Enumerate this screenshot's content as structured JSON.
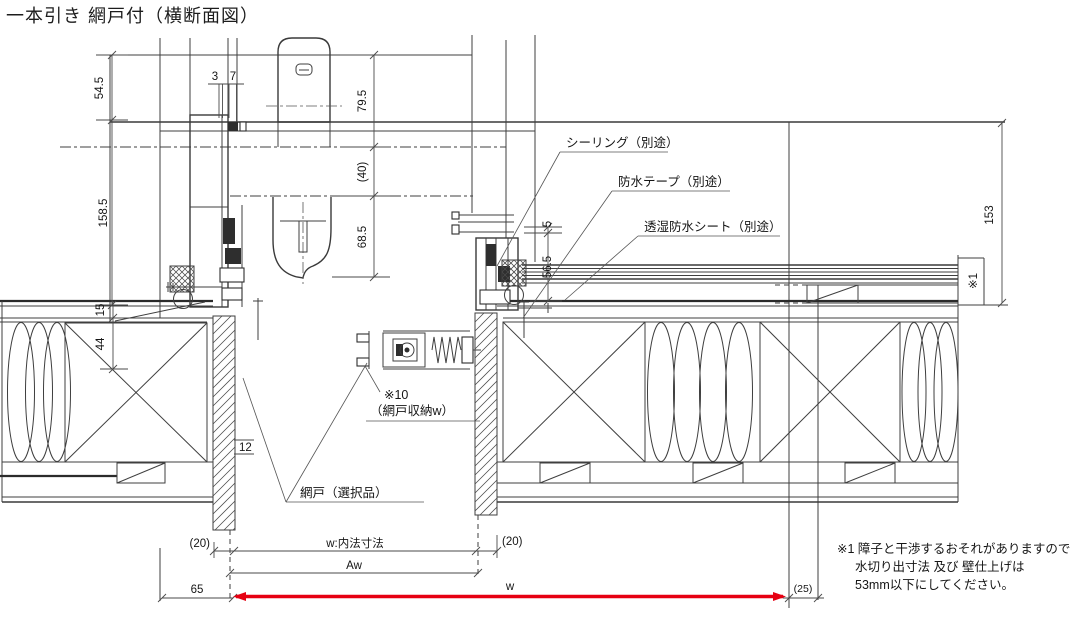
{
  "title": "一本引き 網戸付（横断面図）",
  "colors": {
    "accent_red": "#e60012",
    "line": "#3f3f3f"
  },
  "callouts": {
    "sealing": "シーリング（別途）",
    "waterproof_tape": "防水テープ（別途）",
    "breathable_sheet": "透湿防水シート（別途）"
  },
  "parts": {
    "screen_ref": "※10",
    "screen_stow": "（網戸収納w）",
    "screen_door": "網戸（選択品）",
    "wall_note_ref": "※1"
  },
  "dims": {
    "top_left": "54.5",
    "top_3": "3",
    "top_7": "7",
    "top_right": "79.5",
    "mid_gap": "(40)",
    "left_tall": "158.5",
    "mid_low": "68.5",
    "right_5": "5",
    "right_565": "56.5",
    "far_right": "153",
    "left_15": "15",
    "left_44": "44",
    "left_12": "12",
    "bottom_20_left": "(20)",
    "bottom_20_right": "(20)",
    "bottom_w_inner": "w:内法寸法",
    "bottom_aw": "Aw",
    "bottom_65": "65",
    "bottom_w": "w",
    "bottom_25": "(25)"
  },
  "note": {
    "line1": "※1 障子と干渉するおそれがありますので",
    "line2": "水切り出寸法 及び 壁仕上げは",
    "line3": "53mm以下にしてください。"
  }
}
